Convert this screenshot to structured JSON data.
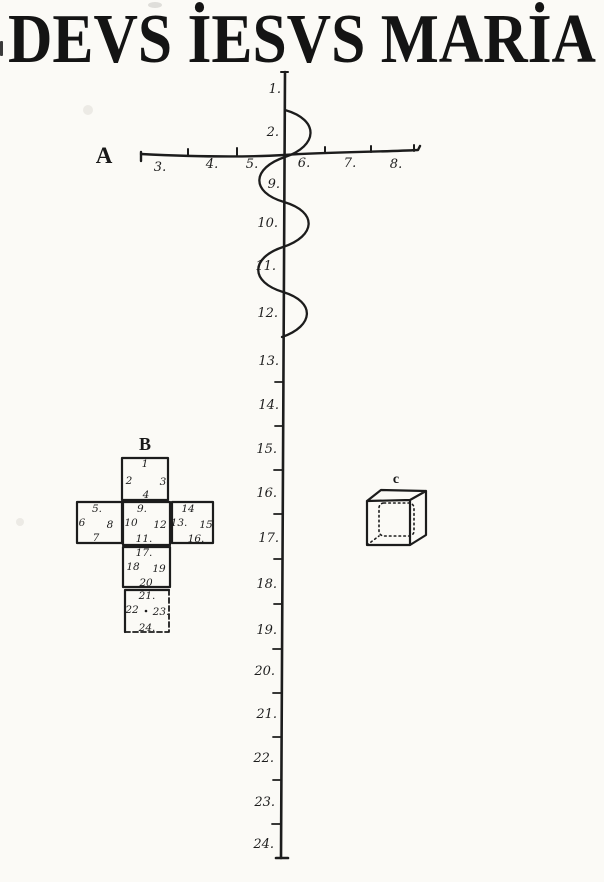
{
  "page": {
    "title": "DEVS İESVS MARİA"
  },
  "colors": {
    "ink": "#1c1c1c",
    "paper": "#fbfaf6"
  },
  "axis": {
    "label": "A",
    "tick_labels": [
      "3.",
      "4.",
      "5.",
      "6.",
      "7.",
      "8."
    ]
  },
  "ruler": {
    "labels": [
      "1.",
      "2.",
      "9.",
      "10.",
      "11.",
      "12.",
      "13.",
      "14.",
      "15.",
      "16.",
      "17.",
      "18.",
      "19.",
      "20.",
      "21.",
      "22.",
      "23.",
      "24."
    ]
  },
  "net": {
    "label": "B",
    "squares": [
      {
        "position": "top",
        "edge_numbers": {
          "top": "1",
          "left": "2",
          "right": "3",
          "bottom": "4"
        }
      },
      {
        "position": "left",
        "edge_numbers": {
          "top": "5.",
          "left": "6",
          "right": "8",
          "bottom": "7"
        }
      },
      {
        "position": "center",
        "edge_numbers": {
          "top": "9.",
          "left": "10",
          "right": "12",
          "bottom": "11."
        }
      },
      {
        "position": "right",
        "edge_numbers": {
          "top": "14",
          "left": "13.",
          "right": "15",
          "bottom": "16."
        }
      },
      {
        "position": "lower",
        "edge_numbers": {
          "top": "17.",
          "left": "18",
          "right": "19",
          "bottom": "20"
        }
      },
      {
        "position": "bottom",
        "edge_numbers": {
          "top": "21.",
          "left": "22",
          "right": "23.",
          "bottom": "24."
        }
      }
    ]
  },
  "cube": {
    "label": "c"
  }
}
